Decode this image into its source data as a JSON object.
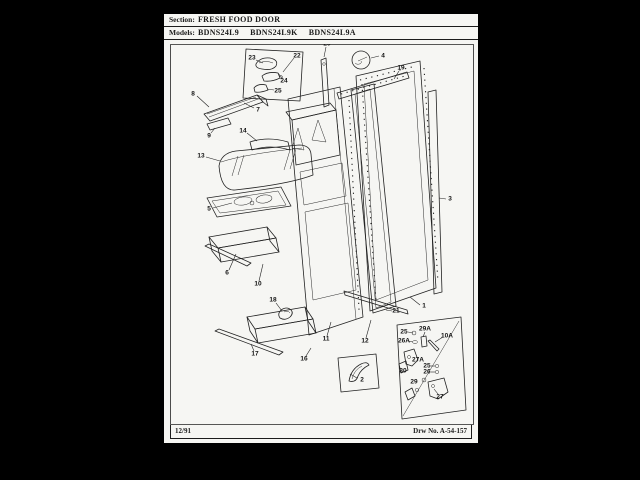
{
  "window": {
    "background": "#000000",
    "page_background": "#f6f6f3",
    "ink_color": "#1c1c1c"
  },
  "header": {
    "section_label": "Section:",
    "section_value": "FRESH FOOD DOOR",
    "models_label": "Models:",
    "models": [
      "BDNS24L9",
      "BDNS24L9K",
      "BDNS24L9A"
    ]
  },
  "footer": {
    "date_code": "12/91",
    "drawing_number": "Drw No. A-54-157"
  },
  "diagram": {
    "description": "Exploded parts diagram of refrigerator fresh food door",
    "callouts": [
      {
        "label": "23",
        "x": 252,
        "y": 58,
        "leader": [
          256,
          60,
          263,
          63
        ]
      },
      {
        "label": "22",
        "x": 297,
        "y": 56,
        "leader": [
          294,
          58,
          283,
          72
        ]
      },
      {
        "label": "24",
        "x": 284,
        "y": 81,
        "leader": [
          282,
          78,
          278,
          73
        ]
      },
      {
        "label": "25",
        "x": 278,
        "y": 91,
        "leader": [
          274,
          90,
          267,
          89
        ]
      },
      {
        "label": "8",
        "x": 193,
        "y": 94,
        "leader": [
          197,
          96,
          209,
          107
        ]
      },
      {
        "label": "7",
        "x": 258,
        "y": 110,
        "leader": [
          254,
          108,
          244,
          103
        ]
      },
      {
        "label": "9",
        "x": 209,
        "y": 136,
        "leader": [
          211,
          133,
          215,
          128
        ]
      },
      {
        "label": "14",
        "x": 243,
        "y": 131,
        "leader": [
          247,
          133,
          257,
          141
        ]
      },
      {
        "label": "13",
        "x": 201,
        "y": 156,
        "leader": [
          206,
          157,
          220,
          161
        ]
      },
      {
        "label": "5",
        "x": 209,
        "y": 209,
        "leader": [
          213,
          208,
          232,
          203
        ]
      },
      {
        "label": "6",
        "x": 227,
        "y": 273,
        "leader": [
          229,
          270,
          236,
          254
        ]
      },
      {
        "label": "10",
        "x": 258,
        "y": 284,
        "leader": [
          259,
          281,
          263,
          264
        ]
      },
      {
        "label": "18",
        "x": 273,
        "y": 300,
        "leader": [
          276,
          303,
          282,
          311
        ]
      },
      {
        "label": "17",
        "x": 255,
        "y": 354,
        "leader": [
          254,
          351,
          251,
          344
        ]
      },
      {
        "label": "16",
        "x": 304,
        "y": 359,
        "leader": [
          306,
          356,
          311,
          348
        ]
      },
      {
        "label": "20",
        "x": 327,
        "y": 44,
        "leader": [
          326,
          47,
          324,
          57
        ]
      },
      {
        "label": "4",
        "x": 383,
        "y": 56,
        "leader": [
          379,
          56,
          371,
          58
        ]
      },
      {
        "label": "19",
        "x": 401,
        "y": 68,
        "leader": [
          399,
          71,
          394,
          79
        ]
      },
      {
        "label": "3",
        "x": 450,
        "y": 199,
        "leader": [
          446,
          199,
          439,
          198
        ]
      },
      {
        "label": "1",
        "x": 424,
        "y": 306,
        "leader": [
          420,
          305,
          410,
          297
        ]
      },
      {
        "label": "21",
        "x": 396,
        "y": 311,
        "leader": [
          392,
          311,
          386,
          310
        ]
      },
      {
        "label": "11",
        "x": 326,
        "y": 339,
        "leader": [
          327,
          336,
          331,
          322
        ]
      },
      {
        "label": "12",
        "x": 365,
        "y": 341,
        "leader": [
          366,
          338,
          371,
          320
        ]
      },
      {
        "label": "2",
        "x": 362,
        "y": 380,
        "leader": [
          357,
          378,
          350,
          374
        ]
      },
      {
        "label": "25",
        "x": 404,
        "y": 332,
        "leader": [
          408,
          332,
          413,
          333
        ]
      },
      {
        "label": "29A",
        "x": 425,
        "y": 329,
        "leader": [
          425,
          332,
          423,
          337
        ]
      },
      {
        "label": "26A",
        "x": 404,
        "y": 341,
        "leader": [
          408,
          341,
          413,
          342
        ]
      },
      {
        "label": "10A",
        "x": 447,
        "y": 336,
        "leader": [
          443,
          337,
          435,
          342
        ]
      },
      {
        "label": "27A",
        "x": 418,
        "y": 360,
        "leader": null
      },
      {
        "label": "30",
        "x": 403,
        "y": 371,
        "leader": null
      },
      {
        "label": "25",
        "x": 427,
        "y": 366,
        "leader": [
          431,
          366,
          435,
          366
        ]
      },
      {
        "label": "26",
        "x": 427,
        "y": 372,
        "leader": [
          431,
          372,
          435,
          372
        ]
      },
      {
        "label": "29",
        "x": 414,
        "y": 382,
        "leader": null
      },
      {
        "label": "27",
        "x": 440,
        "y": 397,
        "leader": [
          438,
          394,
          434,
          389
        ]
      }
    ]
  }
}
